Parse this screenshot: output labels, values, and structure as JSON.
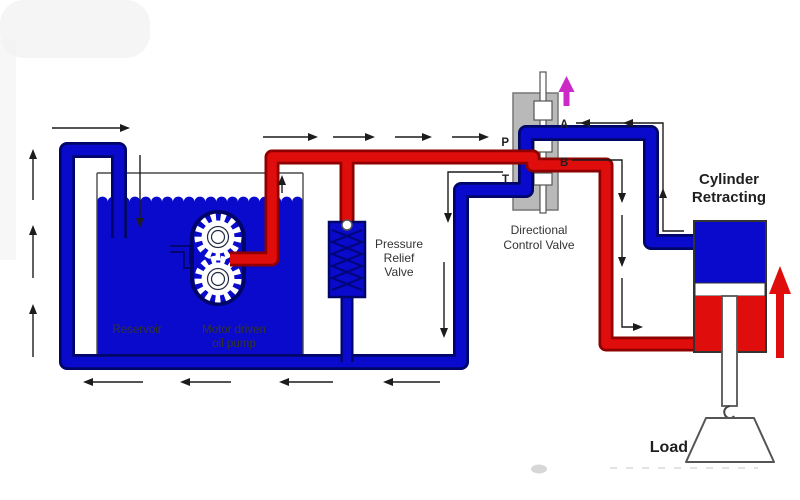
{
  "colors": {
    "pipe_blue": "#0a0acd",
    "pipe_blue_outline": "#000668",
    "pipe_red": "#e00d0d",
    "pipe_red_outline": "#8f0000",
    "valve_gray": "#b9b9b9",
    "spool_arrow_magenta": "#cb2ac6",
    "flow_line": "#1c1c1c",
    "text": "#333333",
    "text_bold": "#1f1f1f"
  },
  "icons": {
    "spool_motion_arrow": "magenta-up-arrow",
    "cylinder_motion_arrow": "red-up-arrow",
    "flow_direction_arrows": "thin-black-arrows",
    "gear_pump_icon": "two-meshed-gears",
    "load_icon": "trapezoid-weight-on-hook"
  },
  "components": {
    "reservoir": {
      "label": "Reservoir"
    },
    "pump": {
      "label_line1": "Motor driven",
      "label_line2": "oil pump"
    },
    "relief_valve": {
      "label_line1": "Pressure",
      "label_line2": "Relief",
      "label_line3": "Valve"
    },
    "directional_valve": {
      "label_line1": "Directional",
      "label_line2": "Control Valve",
      "ports": {
        "p": "P",
        "t": "T",
        "a": "A",
        "b": "B"
      }
    },
    "cylinder": {
      "label_line1": "Cylinder",
      "label_line2": "Retracting"
    },
    "load": {
      "label": "Load"
    }
  }
}
